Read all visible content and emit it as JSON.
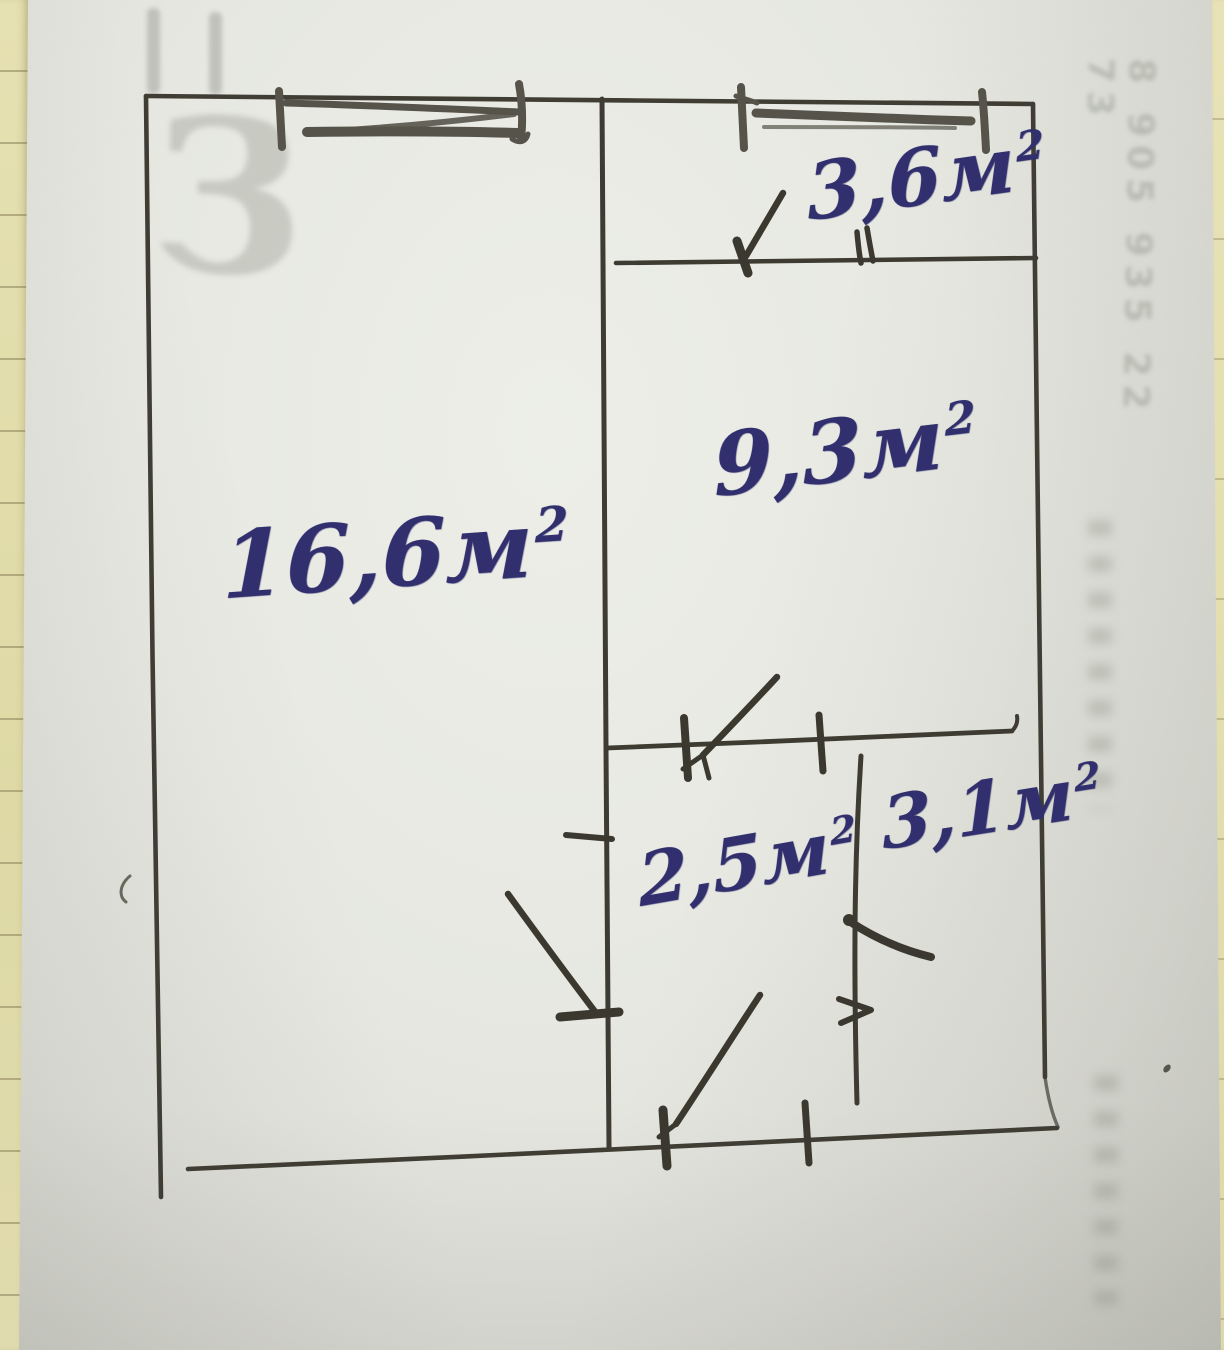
{
  "meta": {
    "description": "Hand-drawn floor plan sketch in pen on white paper, room areas written in blue ink"
  },
  "rooms": [
    {
      "position": "left",
      "label": "16,6м²",
      "value": "16,6",
      "unit": "м",
      "sup": "2"
    },
    {
      "position": "right-middle",
      "label": "9,3м²",
      "value": "9,3",
      "unit": "м",
      "sup": "2"
    },
    {
      "position": "top-right",
      "label": "3,6м²",
      "value": "3,6",
      "unit": "м",
      "sup": "2"
    },
    {
      "position": "bottom-middle",
      "label": "2,5м²",
      "value": "2,5",
      "unit": "м",
      "sup": "2"
    },
    {
      "position": "bottom-right",
      "label": "3,1м²",
      "value": "3,1",
      "unit": "м",
      "sup": "2"
    }
  ],
  "ghost": {
    "letter": "З",
    "phone_column": "8 905 935 22 73"
  }
}
